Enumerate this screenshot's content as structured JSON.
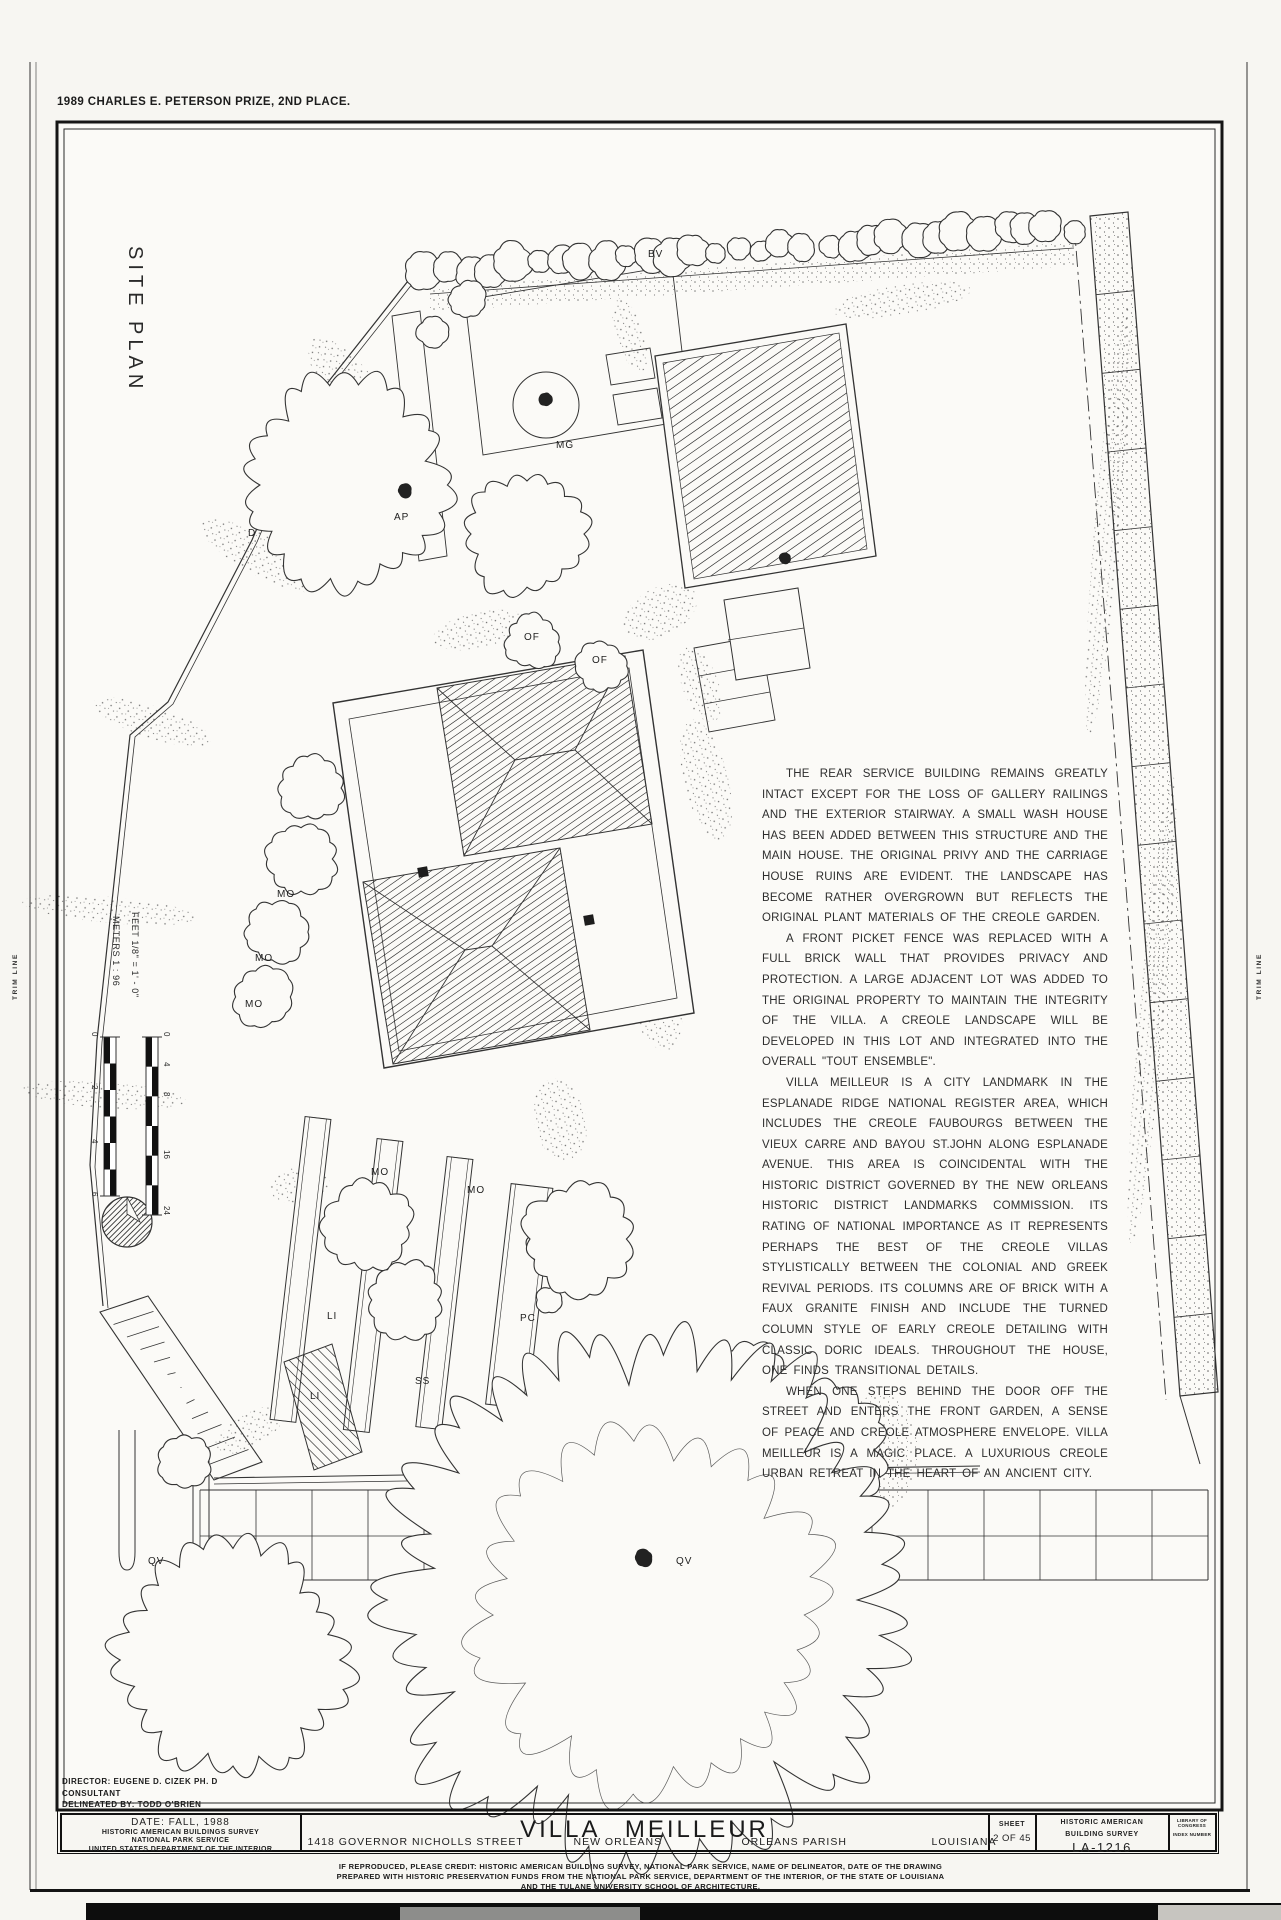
{
  "header": {
    "award": "1989 CHARLES E. PETERSON PRIZE, 2ND PLACE."
  },
  "margins": {
    "trim_label": "TRIM LINE"
  },
  "drawing": {
    "title": "SITE PLAN",
    "scale": {
      "feet_label": "FEET   1/8\" =  1' - 0\"",
      "meters_label": "METERS   1 : 96",
      "feet_ticks": [
        "0",
        "4",
        "8",
        "16",
        "24"
      ],
      "meters_ticks": [
        "0",
        "2",
        "4",
        "6"
      ]
    },
    "plant_labels": [
      "BV",
      "D",
      "MG",
      "AP",
      "OF",
      "OF",
      "MO",
      "MO",
      "MO",
      "MO",
      "MO",
      "LI",
      "LI",
      "SS",
      "PC",
      "QV",
      "QV"
    ]
  },
  "narrative": {
    "paragraphs": [
      "THE REAR SERVICE BUILDING REMAINS GREATLY INTACT EXCEPT FOR THE LOSS OF GALLERY RAILINGS AND THE EXTERIOR STAIRWAY.  A SMALL WASH HOUSE HAS BEEN ADDED BETWEEN THIS STRUCTURE AND THE MAIN HOUSE.  THE ORIGINAL PRIVY AND THE CARRIAGE HOUSE RUINS ARE EVIDENT.  THE LANDSCAPE HAS BECOME RATHER OVERGROWN BUT REFLECTS THE ORIGINAL PLANT MATERIALS OF THE CREOLE GARDEN.",
      "A FRONT PICKET FENCE WAS REPLACED WITH A FULL BRICK WALL THAT PROVIDES PRIVACY AND PROTECTION. A LARGE ADJACENT LOT WAS ADDED TO THE ORIGINAL PROPERTY TO MAINTAIN THE INTEGRITY OF THE VILLA.  A CREOLE LANDSCAPE WILL BE DEVELOPED IN THIS LOT AND INTEGRATED INTO THE OVERALL \"TOUT ENSEMBLE\".",
      "VILLA MEILLEUR IS A CITY LANDMARK IN THE ESPLANADE RIDGE NATIONAL REGISTER AREA, WHICH INCLUDES THE CREOLE FAUBOURGS BETWEEN THE VIEUX CARRE AND BAYOU ST.JOHN ALONG ESPLANADE AVENUE.  THIS AREA IS COINCIDENTAL WITH THE HISTORIC DISTRICT GOVERNED BY THE NEW ORLEANS HISTORIC DISTRICT LANDMARKS COMMISSION.  ITS RATING OF NATIONAL IMPORTANCE AS IT REPRESENTS PERHAPS THE BEST OF THE CREOLE VILLAS STYLISTICALLY BETWEEN THE COLONIAL AND GREEK REVIVAL PERIODS.  ITS COLUMNS ARE OF BRICK WITH A FAUX GRANITE FINISH AND INCLUDE THE TURNED COLUMN STYLE OF EARLY CREOLE DETAILING WITH CLASSIC DORIC IDEALS.  THROUGHOUT THE HOUSE, ONE FINDS TRANSITIONAL DETAILS.",
      "WHEN ONE STEPS BEHIND THE DOOR OFF THE STREET AND ENTERS THE FRONT GARDEN, A SENSE OF PEACE AND CREOLE ATMOSPHERE ENVELOPE.  VILLA MEILLEUR IS A MAGIC PLACE.  A LUXURIOUS CREOLE URBAN RETREAT IN THE HEART OF AN ANCIENT CITY."
    ]
  },
  "titleblock": {
    "director": "DIRECTOR: EUGENE  D.  CIZEK  PH. D",
    "consultant": "CONSULTANT",
    "delineated": "DELINEATED BY: TODD  O'BRIEN",
    "date": "DATE: FALL, 1988",
    "agency1": "HISTORIC AMERICAN BUILDINGS SURVEY",
    "agency2": "NATIONAL PARK SERVICE",
    "agency3": "UNITED STATES DEPARTMENT OF THE INTERIOR",
    "address": "1418  GOVERNOR  NICHOLLS  STREET",
    "building": "VILLA  MEILLEUR",
    "city": "NEW  ORLEANS",
    "parish": "ORLEANS  PARISH",
    "state": "LOUISIANA",
    "sheet_label": "SHEET",
    "sheet_number": "2 OF 45",
    "survey1": "HISTORIC AMERICAN",
    "survey2": "BUILDING SURVEY",
    "survey_number": "LA-1216",
    "loc1": "LIBRARY OF CONGRESS",
    "loc2": "INDEX NUMBER"
  },
  "credits": {
    "line1": "IF REPRODUCED, PLEASE CREDIT: HISTORIC AMERICAN BUILDING SURVEY, NATIONAL PARK SERVICE, NAME OF DELINEATOR, DATE OF THE DRAWING",
    "line2": "PREPARED WITH HISTORIC PRESERVATION FUNDS FROM THE NATIONAL PARK SERVICE, DEPARTMENT OF THE INTERIOR, OF THE  STATE OF LOUISIANA",
    "line3": "AND THE TULANE UNIVERSITY SCHOOL OF ARCHITECTURE."
  }
}
